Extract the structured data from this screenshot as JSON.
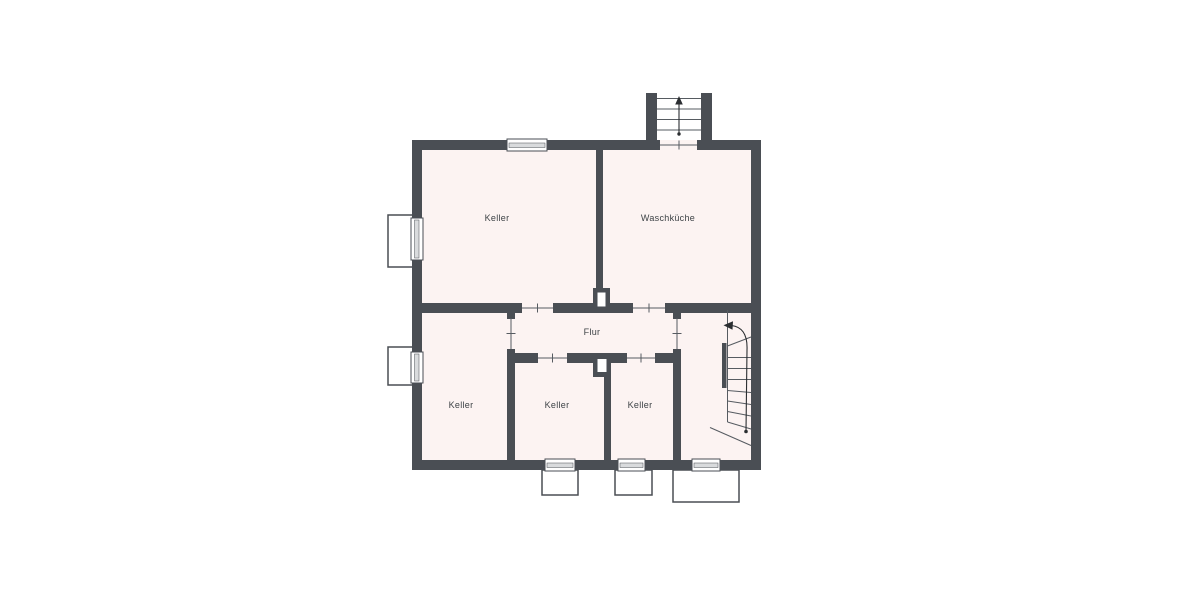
{
  "plan": {
    "rooms": [
      {
        "id": "keller-top-left",
        "label": "Keller"
      },
      {
        "id": "waschkueche",
        "label": "Waschküche"
      },
      {
        "id": "flur",
        "label": "Flur"
      },
      {
        "id": "keller-bottom-left",
        "label": "Keller"
      },
      {
        "id": "keller-bottom-middle",
        "label": "Keller"
      },
      {
        "id": "keller-bottom-right",
        "label": "Keller"
      }
    ]
  },
  "colors": {
    "wall": "#4a4e54",
    "room": "#fcf3f2",
    "glazing": "#d9dbdd",
    "line": "#565b61",
    "text": "#3e4347",
    "background": "#ffffff"
  }
}
